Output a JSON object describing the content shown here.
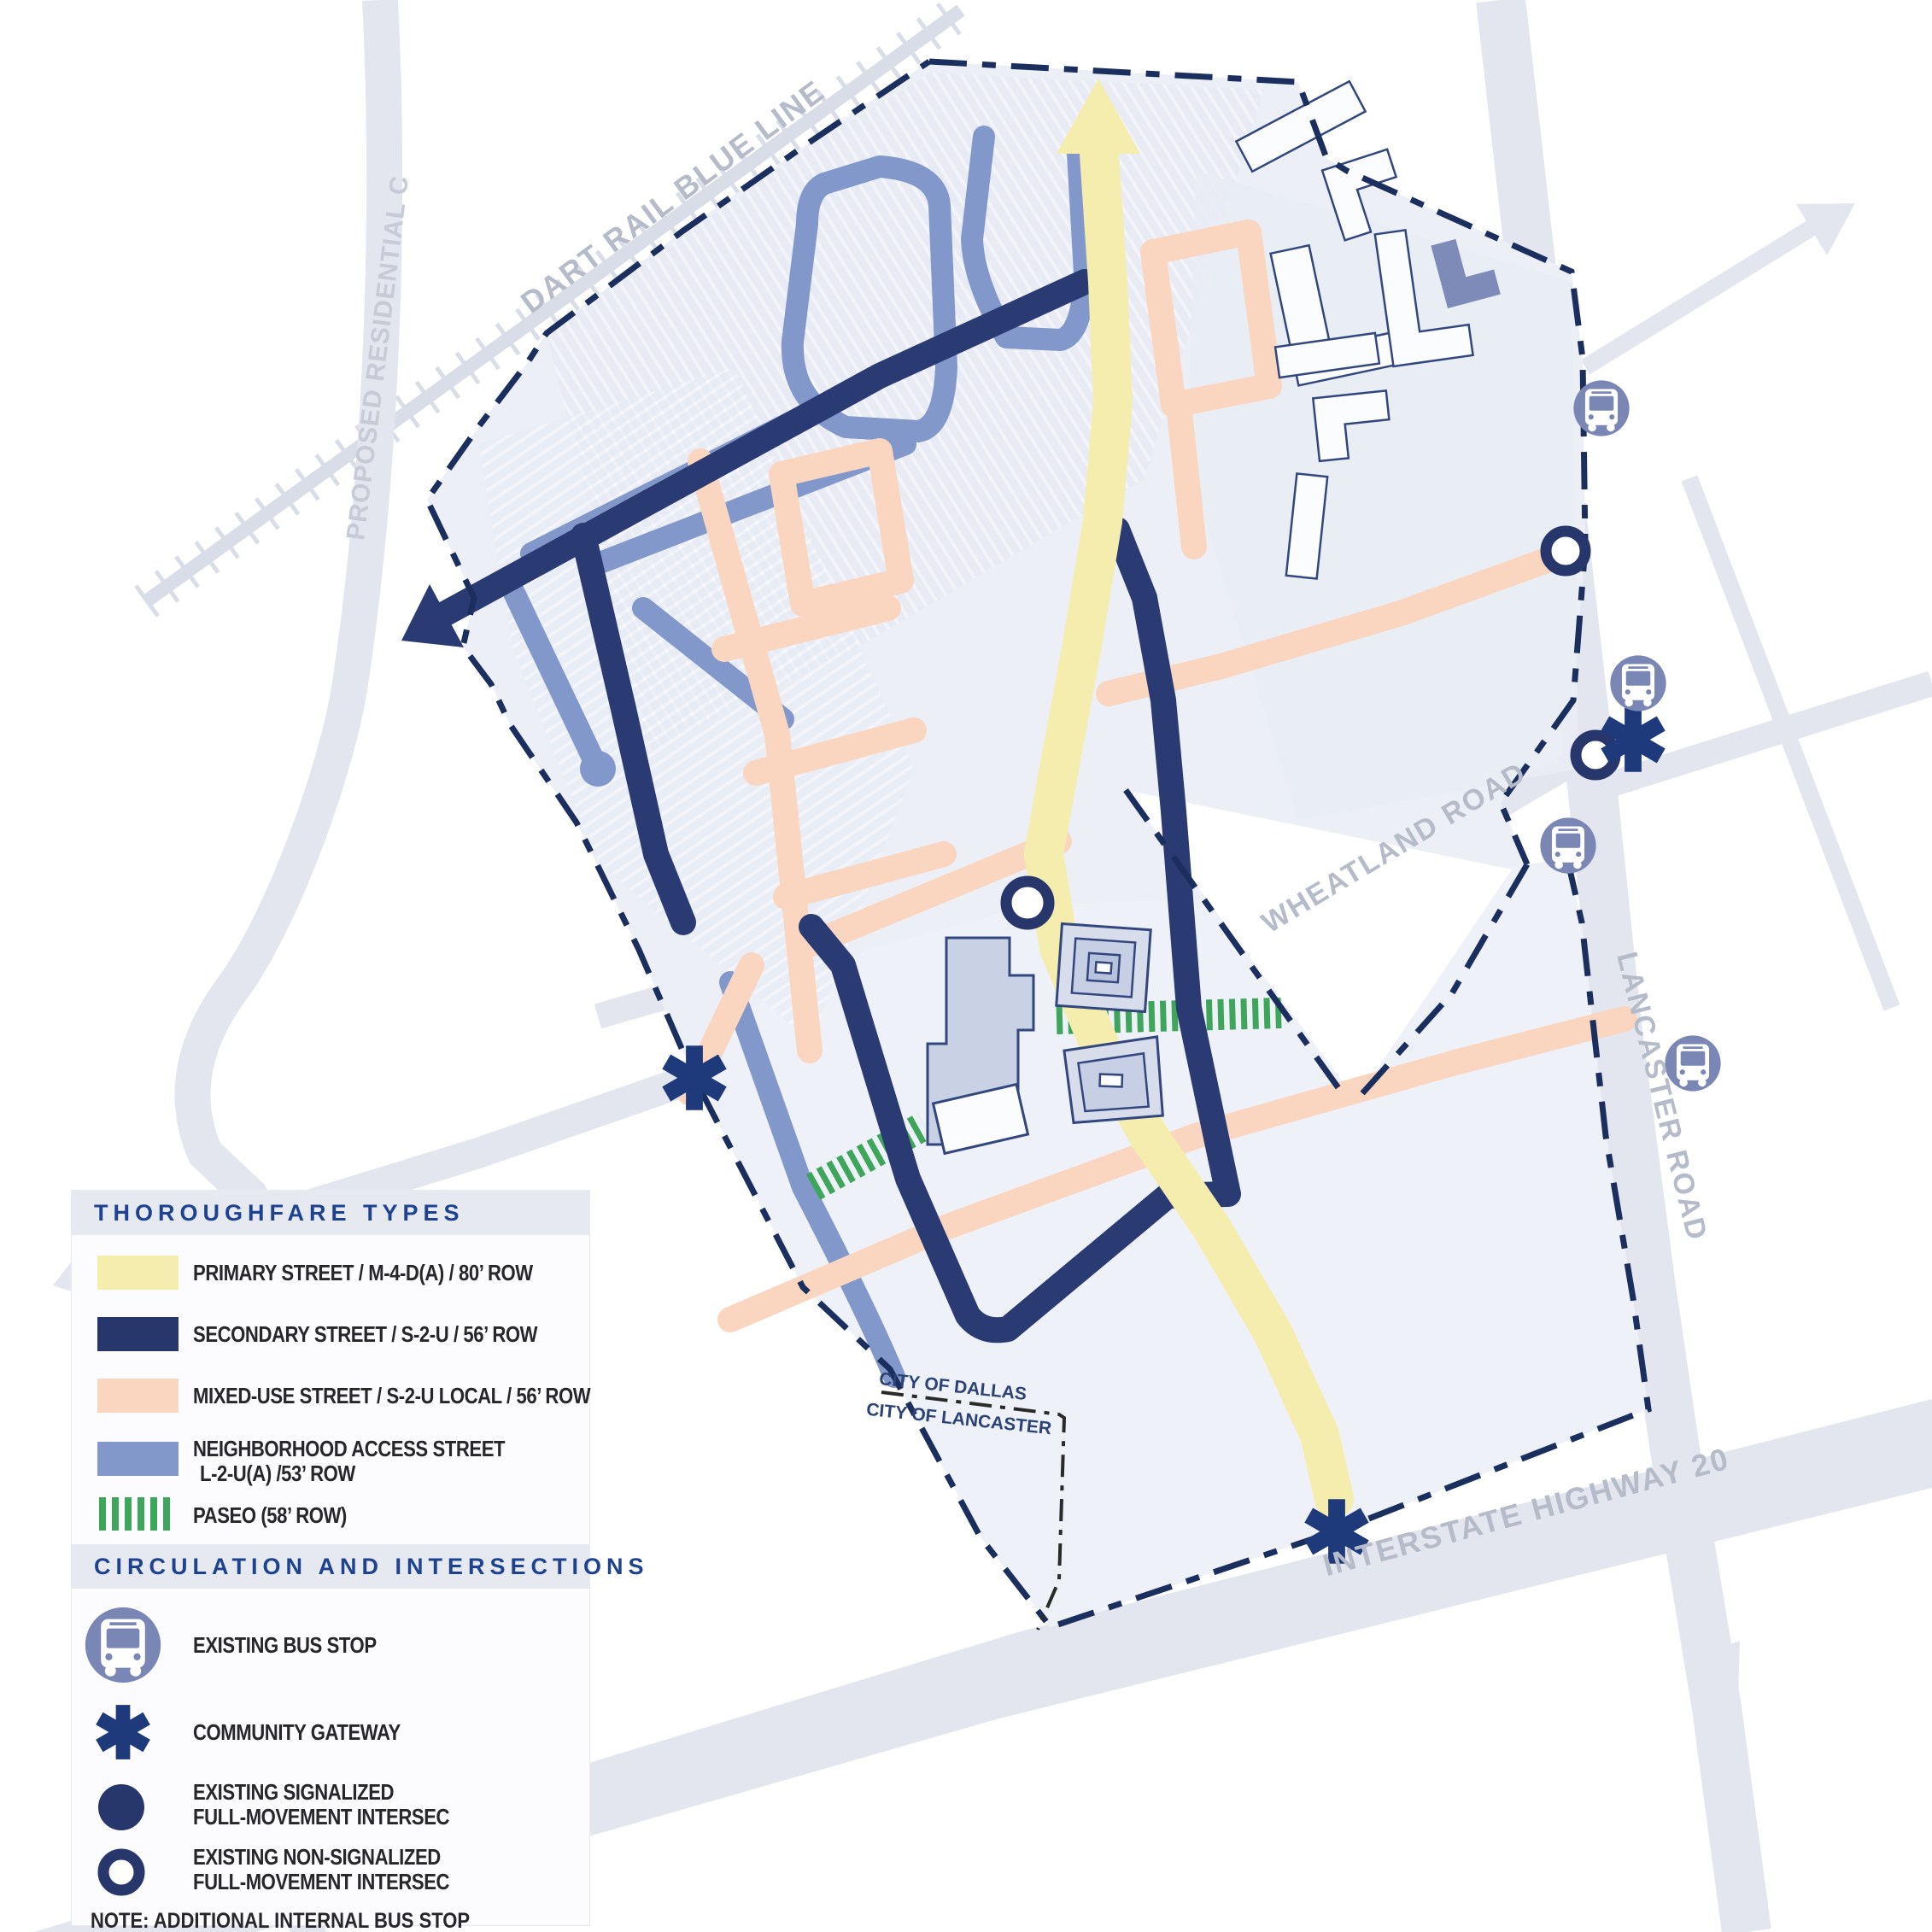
{
  "map": {
    "labels": {
      "dart_rail": "DART RAIL BLUE LINE",
      "proposed_residential": "PROPOSED RESIDENTIAL C",
      "wheatland": "WHEATLAND ROAD",
      "lancaster": "LANCASTER ROAD",
      "interstate": "INTERSTATE HIGHWAY 20",
      "city_dallas": "CITY OF DALLAS",
      "city_lancaster": "CITY OF LANCASTER"
    },
    "colors": {
      "primary_street": "#F5EDAD",
      "secondary_street": "#2A3A72",
      "mixed_use_street": "#FAD6C0",
      "neighborhood_street": "#8298CB",
      "paseo": "#3DA65B",
      "boundary": "#1B2F5E",
      "context_road": "#E3E6EE",
      "rail": "#D9DDE7",
      "bus_icon": "#7A87B5",
      "road_label": "#B5BBC9"
    }
  },
  "legend": {
    "thoroughfare": {
      "header": "THOROUGHFARE TYPES",
      "items": [
        {
          "color": "#F5EDAD",
          "label": "PRIMARY STREET / M-4-D(A) / 80’ ROW"
        },
        {
          "color": "#27366B",
          "label": "SECONDARY STREET / S-2-U / 56’ ROW"
        },
        {
          "color": "#FAD6C0",
          "label": "MIXED-USE STREET / S-2-U LOCAL / 56’ ROW"
        },
        {
          "color": "#8298CB",
          "label": "NEIGHBORHOOD ACCESS STREET",
          "label2": "L-2-U(A) /53’ ROW"
        },
        {
          "color": "#3DA65B",
          "label": "PASEO (58’ ROW)"
        }
      ]
    },
    "circulation": {
      "header": "CIRCULATION AND INTERSECTIONS",
      "items": [
        {
          "icon": "bus",
          "label": "EXISTING BUS STOP"
        },
        {
          "icon": "asterisk",
          "label": "COMMUNITY GATEWAY"
        },
        {
          "icon": "filled-circle",
          "label": "EXISTING SIGNALIZED",
          "label2": "FULL-MOVEMENT INTERSEC"
        },
        {
          "icon": "open-circle",
          "label": "EXISTING NON-SIGNALIZED",
          "label2": "FULL-MOVEMENT INTERSEC"
        }
      ]
    },
    "note_line1": "NOTE: ADDITIONAL INTERNAL BUS STOP",
    "note_line2": "LOCATIONS TO BE COORDINATED WITH DART."
  }
}
